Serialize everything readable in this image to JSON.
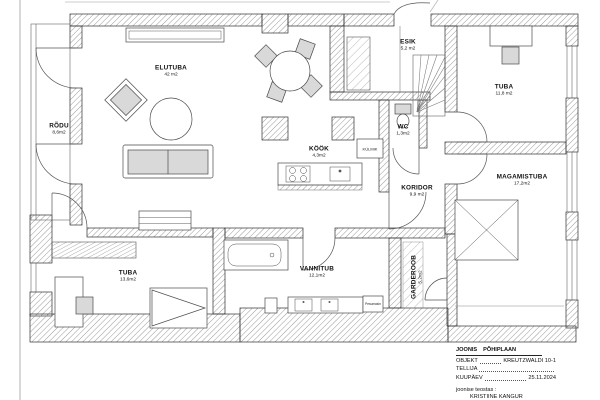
{
  "rooms": [
    {
      "name": "ELUTUBA",
      "area": "42 m2"
    },
    {
      "name": "RÕDU",
      "area": "8,6m2"
    },
    {
      "name": "ESIK",
      "area": "5,2 m2"
    },
    {
      "name": "TUBA",
      "area": "11,8 m2"
    },
    {
      "name": "WC",
      "area": "1,3m2"
    },
    {
      "name": "KÖÖK",
      "area": "4,3m2"
    },
    {
      "name": "KORIDOR",
      "area": "9,9 m2"
    },
    {
      "name": "MAGAMISTUBA",
      "area": "17,2m2"
    },
    {
      "name": "GARDEROOB",
      "area": "5,2m2"
    },
    {
      "name": "VANNITUB",
      "area": "12,1m2"
    },
    {
      "name": "TUBA",
      "area": "13,6m2"
    }
  ],
  "appliances": {
    "fridge": "KÜLMIK",
    "washer": "Pesumasin"
  },
  "title_block": {
    "drawing_label": "JOONIS",
    "drawing_name": "PÕHIPLAAN",
    "object_label": "OBJEKT",
    "object_value": "KREUTZWALDI 10-1",
    "client_label": "TELLIJA",
    "date_label": "KUUPÄEV",
    "date_value": "25.11.2024",
    "author_caption": "joonise teostas :",
    "author_name": "KRISTIINE KANGUR"
  },
  "colors": {
    "wall_hatch": "#9a9a9a",
    "outline": "#333333",
    "furniture_fill": "#d9d9d9"
  }
}
